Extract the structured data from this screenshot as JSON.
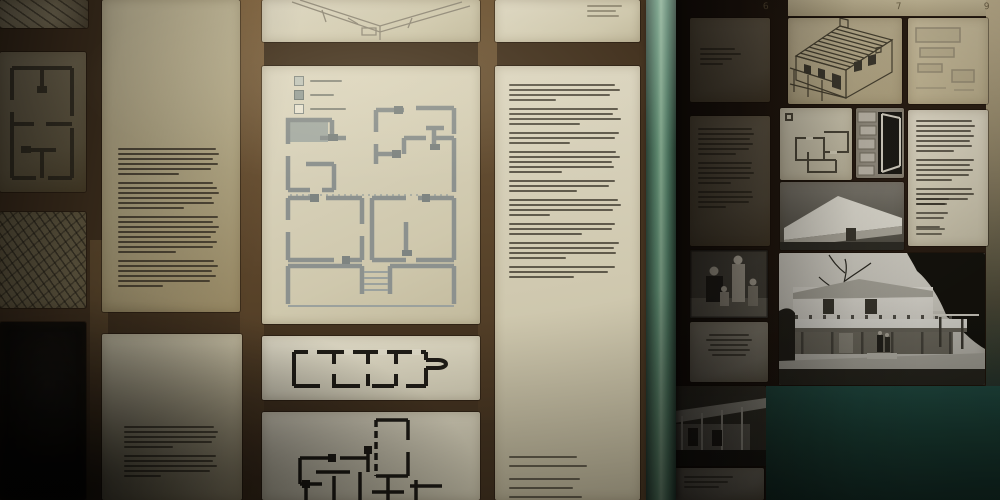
{
  "scene": {
    "type": "photograph",
    "subject": "dim museum exhibition wall of framed panels with architectural floor plans, axonometric building drawings, black-and-white photographs and small printed text panels, a green pole in front and a dark teal wall at lower right",
    "lighting": "bright centre, heavy dark vignette at left and bottom corners"
  },
  "palette": {
    "frame_dark_left": "#45331f",
    "frame_dark_right": "#1c130c",
    "panel_cream": "#d9d3bb",
    "panel_tan": "#c0b494",
    "teal_wall": "#1d463b",
    "pole_green": "#5f8f72",
    "wall_top_right": "#c2b28d"
  },
  "wall_marks": {
    "m1": "6",
    "m2": "7",
    "m3": "9"
  },
  "legend": {
    "items": [
      {
        "name": "light-walls",
        "swatch": "#c2c6ba",
        "border": "#878c85",
        "label_w": 32
      },
      {
        "name": "gray-walls",
        "swatch": "#98a09a",
        "border": "#78807a",
        "label_w": 24
      },
      {
        "name": "open-walls",
        "swatch": "#e8e3d1",
        "border": "#8b9089",
        "label_w": 36
      }
    ]
  },
  "text_blocks": {
    "col2_main": {
      "paragraphs": [
        [
          92,
          95,
          90,
          94,
          88,
          58
        ],
        [
          90,
          93,
          95,
          89,
          91,
          62
        ],
        [
          94,
          90,
          95,
          92,
          88,
          93,
          90,
          55
        ],
        [
          91,
          94,
          89,
          92,
          87,
          42
        ]
      ]
    },
    "col2_note": {
      "paragraphs": [
        [
          88,
          92,
          90,
          86,
          48
        ],
        [
          90,
          87,
          91,
          84,
          36
        ]
      ]
    },
    "col4_main": {
      "paragraphs": [
        [
          90,
          94,
          86,
          40
        ],
        [
          92,
          88,
          95,
          60
        ],
        [
          93,
          90,
          52
        ],
        [
          91,
          94,
          87,
          89,
          45
        ],
        [
          90,
          85,
          58
        ],
        [
          92,
          95,
          88,
          35
        ],
        [
          90,
          87,
          62
        ],
        [
          93,
          89,
          91,
          48
        ],
        [
          90,
          84,
          55
        ]
      ]
    },
    "col4_captions": {
      "paragraphs": [
        [
          58,
          66
        ],
        [
          60,
          54,
          62
        ]
      ]
    },
    "p10_note": {
      "paragraphs": [
        [
          80,
          65,
          72
        ]
      ]
    },
    "ra1_lines": {
      "paragraphs": [
        [
          60,
          70,
          55,
          40
        ]
      ]
    },
    "ra2_text": {
      "paragraphs": [
        [
          84,
          88,
          82,
          86,
          80,
          60
        ],
        [
          85,
          83,
          87,
          81,
          52
        ],
        [
          84,
          86,
          80,
          44
        ]
      ]
    },
    "ra4_card": {
      "paragraphs": [
        [
          70,
          78,
          66,
          74,
          58
        ]
      ]
    },
    "ra6_card": {
      "paragraphs": [
        [
          72,
          64,
          52
        ]
      ]
    },
    "rb5_main": {
      "paragraphs": [
        [
          88,
          92,
          86,
          90,
          84,
          88,
          60
        ],
        [
          90,
          85,
          89,
          83,
          56
        ],
        [
          87,
          90,
          82,
          48
        ]
      ]
    },
    "rb5_address": {
      "paragraphs": [
        [
          52,
          46
        ],
        [
          50,
          44
        ],
        [
          38
        ]
      ]
    },
    "rb5_footer": {
      "paragraphs": [
        [
          46,
          40
        ]
      ]
    }
  }
}
